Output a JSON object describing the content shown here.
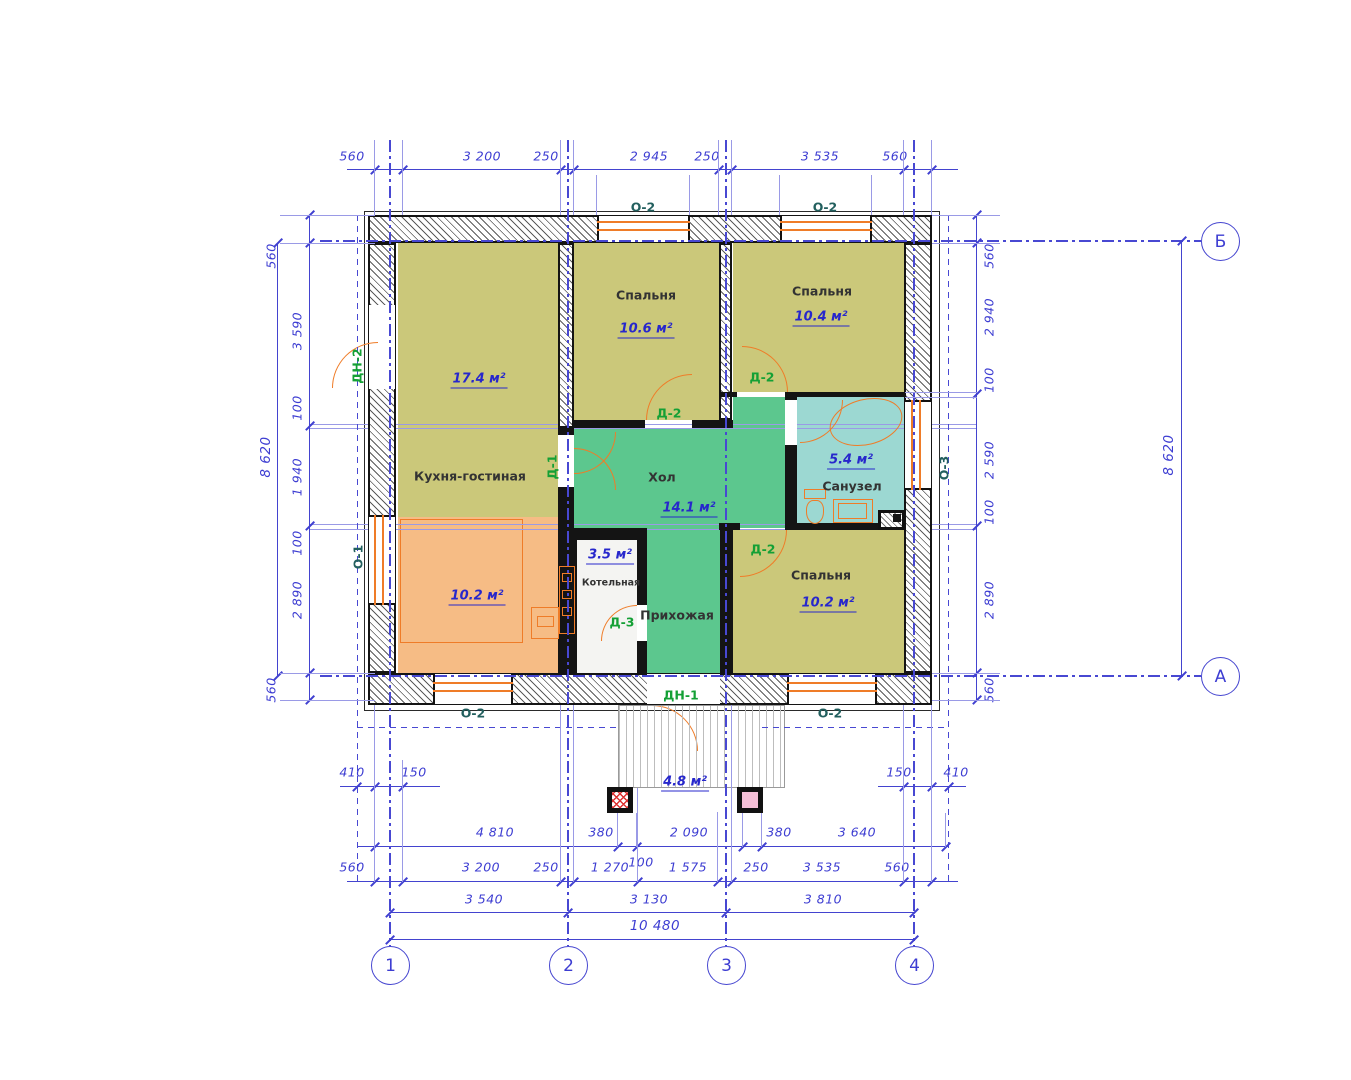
{
  "rooms": {
    "kitchen_living": {
      "name": "Кухня-гостиная",
      "area": "17.4 м²",
      "zone_area": "10.2 м²"
    },
    "bedroom_top": {
      "name": "Спальня",
      "area": "10.6 м²"
    },
    "bedroom_right": {
      "name": "Спальня",
      "area": "10.4 м²"
    },
    "bedroom_bottom": {
      "name": "Спальня",
      "area": "10.2 м²"
    },
    "hall": {
      "name": "Хол",
      "area": "14.1 м²"
    },
    "bathroom": {
      "name": "Санузел",
      "area": "5.4 м²"
    },
    "boiler": {
      "name": "Котельная",
      "area": "3.5 м²"
    },
    "entry": {
      "name": "Прихожая"
    },
    "porch": {
      "area": "4.8 м²"
    }
  },
  "doors": {
    "d1": "Д-1",
    "d2": "Д-2",
    "d3": "Д-3",
    "dn1": "ДН-1",
    "dn2": "ДН-2"
  },
  "windows": {
    "o1": "О-1",
    "o2": "О-2",
    "o3": "О-3"
  },
  "axes": {
    "c1": "1",
    "c2": "2",
    "c3": "3",
    "c4": "4",
    "cA": "А",
    "cB": "Б"
  },
  "dims": {
    "top": [
      "560",
      "3 200",
      "250",
      "2 945",
      "250",
      "3 535",
      "560"
    ],
    "left": [
      "560",
      "3 590",
      "100",
      "1 940",
      "100",
      "2 890",
      "560"
    ],
    "right": [
      "560",
      "2 940",
      "100",
      "2 590",
      "100",
      "2 890",
      "560"
    ],
    "side_total": "8 620",
    "row1_left": [
      "410",
      "150"
    ],
    "row1_right": [
      "150",
      "410"
    ],
    "row2": [
      "4 810",
      "380",
      "2 090",
      "380",
      "3 640"
    ],
    "row2_extra": "100",
    "row3": [
      "560",
      "3 200",
      "250",
      "1 270",
      "1 575",
      "250",
      "3 535",
      "560"
    ],
    "row4": [
      "3 540",
      "3 130",
      "3 810"
    ],
    "bottom_total": "10 480"
  },
  "colors": {
    "dimension_blue": "#4343cf",
    "wall_black": "#141414",
    "room_olive": "#cbc87a",
    "room_green": "#5cc78e",
    "room_cyan": "#9cd8d2",
    "room_orange": "#f6bc85",
    "door_orange": "#ef7c28",
    "door_label_green": "#14a035",
    "window_label_teal": "#225f5e",
    "area_label_blue": "#2727cc",
    "column_pink": "#f5c0d8",
    "column_red_hatch": "#dd3333"
  }
}
